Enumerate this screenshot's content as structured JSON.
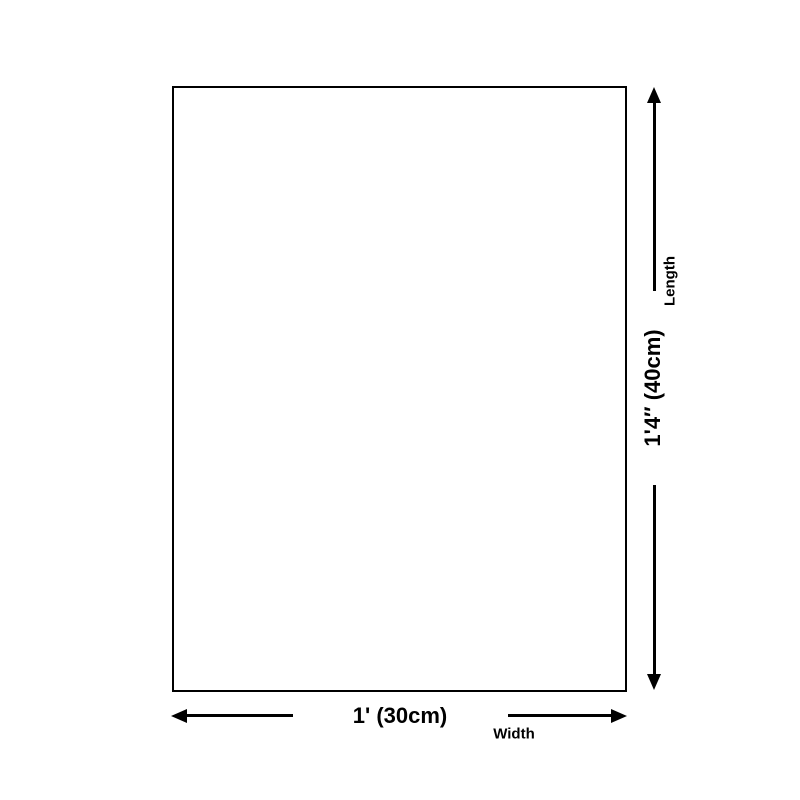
{
  "diagram": {
    "type": "product-dimension-diagram",
    "length": {
      "value": "1'4″ (40cm)",
      "label": "Length"
    },
    "width": {
      "value": "1' (30cm)",
      "label": "Width"
    },
    "colors": {
      "background": "#ffffff",
      "line": "#000000",
      "text": "#000000"
    }
  }
}
